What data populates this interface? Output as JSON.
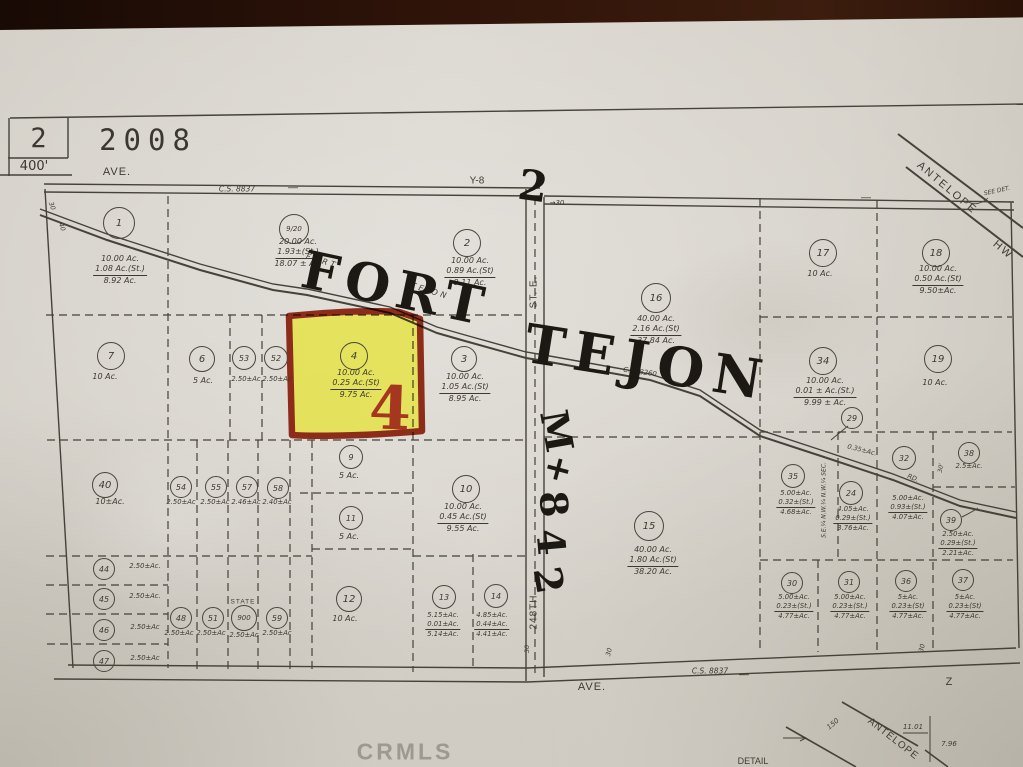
{
  "header": {
    "sheet": "2",
    "year": "2008",
    "scale": "400'"
  },
  "watermark": "CRMLS",
  "colors": {
    "paper": "#d8d4cd",
    "ink": "#45423a",
    "highlight": "#e6e42e",
    "highlight_border": "#8e2c1b",
    "marker": "#1c1914",
    "red_annotation": "#a53620",
    "photo_background": "#2a150d"
  },
  "parcels": [
    {
      "n": "1",
      "cx": 118,
      "cy": 222,
      "r": 15,
      "lx": 120,
      "ly": 254,
      "lines": [
        "10.00 Ac.",
        "1.08 Ac.(St.)",
        "8.92 Ac."
      ]
    },
    {
      "n": "9/20",
      "cx": 293,
      "cy": 228,
      "r": 14,
      "lx": 298,
      "ly": 237,
      "lines": [
        "20.00 Ac.",
        "1.93±(St.)",
        "18.07 ± Ac."
      ]
    },
    {
      "n": "2",
      "cx": 466,
      "cy": 242,
      "r": 13,
      "lx": 470,
      "ly": 256,
      "lines": [
        "10.00 Ac.",
        "0.89 Ac.(St)",
        "9.11 Ac."
      ]
    },
    {
      "n": "7",
      "cx": 110,
      "cy": 355,
      "r": 13,
      "lx": 105,
      "ly": 372,
      "lines": [
        "10 Ac."
      ]
    },
    {
      "n": "6",
      "cx": 201,
      "cy": 358,
      "r": 12,
      "lx": 203,
      "ly": 376,
      "lines": [
        "5 Ac."
      ]
    },
    {
      "n": "53",
      "cx": 243,
      "cy": 357,
      "r": 11,
      "sm": true,
      "lx": 246,
      "ly": 375,
      "lines": [
        "2.50±Ac"
      ]
    },
    {
      "n": "52",
      "cx": 275,
      "cy": 357,
      "r": 11,
      "sm": true,
      "lx": 277,
      "ly": 375,
      "lines": [
        "2.50±Ac"
      ]
    },
    {
      "n": "4",
      "cx": 353,
      "cy": 355,
      "r": 13,
      "lx": 356,
      "ly": 368,
      "lines": [
        "10.00 Ac.",
        "0.25 Ac.(St)",
        "9.75 Ac."
      ]
    },
    {
      "n": "3",
      "cx": 463,
      "cy": 358,
      "r": 12,
      "lx": 465,
      "ly": 372,
      "lines": [
        "10.00 Ac.",
        "1.05 Ac.(St)",
        "8.95 Ac."
      ]
    },
    {
      "n": "16",
      "cx": 655,
      "cy": 297,
      "r": 14,
      "lx": 656,
      "ly": 314,
      "lines": [
        "40.00 Ac.",
        "2.16 Ac.(St)",
        "37.84 Ac."
      ]
    },
    {
      "n": "17",
      "cx": 822,
      "cy": 252,
      "r": 13,
      "lx": 820,
      "ly": 269,
      "lines": [
        "10 Ac."
      ]
    },
    {
      "n": "18",
      "cx": 935,
      "cy": 252,
      "r": 13,
      "lx": 938,
      "ly": 264,
      "lines": [
        "10.00 Ac.",
        "0.50 Ac.(St)",
        "9.50±Ac."
      ]
    },
    {
      "n": "34",
      "cx": 822,
      "cy": 360,
      "r": 13,
      "lx": 825,
      "ly": 376,
      "lines": [
        "10.00 Ac.",
        "0.01 ± Ac.(St.)",
        "9.99 ± Ac."
      ]
    },
    {
      "n": "19",
      "cx": 937,
      "cy": 358,
      "r": 13,
      "lx": 935,
      "ly": 378,
      "lines": [
        "10 Ac."
      ]
    },
    {
      "n": "29",
      "cx": 851,
      "cy": 417,
      "r": 10,
      "lx": 851,
      "ly": 430,
      "lines": []
    },
    {
      "n": "35",
      "cx": 792,
      "cy": 475,
      "r": 11,
      "sm": true,
      "lx": 796,
      "ly": 489,
      "lines": [
        "5.00±Ac.",
        "0.32±(St.)",
        "4.68±Ac."
      ]
    },
    {
      "n": "24",
      "cx": 850,
      "cy": 492,
      "r": 11,
      "sm": true,
      "lx": 853,
      "ly": 505,
      "lines": [
        "4.05±Ac.",
        "0.29±(St.)",
        "3.76±Ac."
      ]
    },
    {
      "n": "32",
      "cx": 903,
      "cy": 457,
      "r": 11,
      "sm": true,
      "lx": 908,
      "ly": 494,
      "lines": [
        "5.00±Ac.",
        "0.93±(St.)",
        "4.07±Ac."
      ]
    },
    {
      "n": "38",
      "cx": 968,
      "cy": 452,
      "r": 10,
      "sm": true,
      "lx": 969,
      "ly": 462,
      "lines": [
        "2.5±Ac."
      ]
    },
    {
      "n": "39",
      "cx": 950,
      "cy": 519,
      "r": 10,
      "sm": true,
      "lx": 958,
      "ly": 530,
      "lines": [
        "2.50±Ac.",
        "0.29±(St.)",
        "2.21±Ac."
      ]
    },
    {
      "n": "15",
      "cx": 648,
      "cy": 525,
      "r": 14,
      "lx": 653,
      "ly": 545,
      "lines": [
        "40.00 Ac.",
        "1.80 Ac.(St)",
        "38.20 Ac."
      ]
    },
    {
      "n": "10",
      "cx": 465,
      "cy": 488,
      "r": 13,
      "lx": 463,
      "ly": 502,
      "lines": [
        "10.00 Ac.",
        "0.45 Ac.(St)",
        "9.55 Ac."
      ]
    },
    {
      "n": "9",
      "cx": 350,
      "cy": 456,
      "r": 11,
      "lx": 349,
      "ly": 471,
      "lines": [
        "5 Ac."
      ]
    },
    {
      "n": "11",
      "cx": 350,
      "cy": 517,
      "r": 11,
      "lx": 349,
      "ly": 532,
      "lines": [
        "5 Ac."
      ]
    },
    {
      "n": "40",
      "cx": 104,
      "cy": 484,
      "r": 12,
      "lx": 110,
      "ly": 497,
      "lines": [
        "10±Ac."
      ]
    },
    {
      "n": "54",
      "cx": 180,
      "cy": 486,
      "r": 10,
      "sm": true,
      "lx": 181,
      "ly": 498,
      "lines": [
        "2.50±Ac"
      ]
    },
    {
      "n": "55",
      "cx": 215,
      "cy": 486,
      "r": 10,
      "sm": true,
      "lx": 215,
      "ly": 498,
      "lines": [
        "2.50±Ac"
      ]
    },
    {
      "n": "57",
      "cx": 246,
      "cy": 486,
      "r": 10,
      "sm": true,
      "lx": 246,
      "ly": 498,
      "lines": [
        "2.46±Ac"
      ]
    },
    {
      "n": "58",
      "cx": 277,
      "cy": 487,
      "r": 10,
      "sm": true,
      "lx": 277,
      "ly": 498,
      "lines": [
        "2.40±Ac"
      ]
    },
    {
      "n": "44",
      "cx": 103,
      "cy": 568,
      "r": 10,
      "sm": true,
      "lx": 145,
      "ly": 562,
      "lines": [
        "2.50±Ac."
      ]
    },
    {
      "n": "45",
      "cx": 103,
      "cy": 598,
      "r": 10,
      "sm": true,
      "lx": 145,
      "ly": 592,
      "lines": [
        "2.50±Ac."
      ]
    },
    {
      "n": "46",
      "cx": 103,
      "cy": 629,
      "r": 10,
      "sm": true,
      "lx": 145,
      "ly": 623,
      "lines": [
        "2.50±Ac"
      ]
    },
    {
      "n": "47",
      "cx": 103,
      "cy": 660,
      "r": 10,
      "sm": true,
      "lx": 145,
      "ly": 654,
      "lines": [
        "2.50±Ac"
      ]
    },
    {
      "n": "48",
      "cx": 180,
      "cy": 617,
      "r": 10,
      "sm": true,
      "lx": 179,
      "ly": 629,
      "lines": [
        "2.50±Ac"
      ]
    },
    {
      "n": "51",
      "cx": 212,
      "cy": 617,
      "r": 10,
      "sm": true,
      "lx": 211,
      "ly": 629,
      "lines": [
        "2.50±Ac"
      ]
    },
    {
      "n": "900",
      "cx": 243,
      "cy": 617,
      "r": 12,
      "sm": true,
      "lx": 244,
      "ly": 631,
      "lines": [
        "2.50±Ac"
      ]
    },
    {
      "n": "59",
      "cx": 276,
      "cy": 617,
      "r": 10,
      "sm": true,
      "lx": 277,
      "ly": 629,
      "lines": [
        "2.50±Ac"
      ]
    },
    {
      "n": "12",
      "cx": 348,
      "cy": 598,
      "r": 12,
      "lx": 345,
      "ly": 614,
      "lines": [
        "10 Ac."
      ]
    },
    {
      "n": "13",
      "cx": 443,
      "cy": 596,
      "r": 11,
      "sm": true,
      "lx": 443,
      "ly": 611,
      "lines": [
        "5.15±Ac.",
        "0.01±Ac.",
        "5.14±Ac."
      ]
    },
    {
      "n": "14",
      "cx": 495,
      "cy": 595,
      "r": 11,
      "sm": true,
      "lx": 492,
      "ly": 611,
      "lines": [
        "4.85±Ac.",
        "0.44±Ac.",
        "4.41±Ac."
      ]
    },
    {
      "n": "30",
      "cx": 791,
      "cy": 582,
      "r": 10,
      "sm": true,
      "lx": 794,
      "ly": 593,
      "lines": [
        "5.00±Ac.",
        "0.23±(St.)",
        "4.77±Ac."
      ]
    },
    {
      "n": "31",
      "cx": 848,
      "cy": 581,
      "r": 10,
      "sm": true,
      "lx": 850,
      "ly": 593,
      "lines": [
        "5.00±Ac.",
        "0.23±(St.)",
        "4.77±Ac."
      ]
    },
    {
      "n": "36",
      "cx": 905,
      "cy": 580,
      "r": 10,
      "sm": true,
      "lx": 908,
      "ly": 593,
      "lines": [
        "5±Ac.",
        "0.23±(St)",
        "4.77±Ac."
      ]
    },
    {
      "n": "37",
      "cx": 962,
      "cy": 579,
      "r": 10,
      "sm": true,
      "lx": 965,
      "ly": 593,
      "lines": [
        "5±Ac.",
        "0.23±(St)",
        "4.77±Ac."
      ]
    }
  ],
  "notes": [
    {
      "t": "AVE.",
      "x": 117,
      "y": 172,
      "s": 11,
      "sp": 1,
      "name": "ave-top-label"
    },
    {
      "t": "C.S. 8837",
      "x": 237,
      "y": 189,
      "s": 7.5,
      "i": true,
      "name": "survey-number-top"
    },
    {
      "t": "Y-8",
      "x": 477,
      "y": 181,
      "s": 10,
      "name": "grid-ref-y8"
    },
    {
      "t": "—",
      "x": 293,
      "y": 188,
      "s": 10
    },
    {
      "t": "—",
      "x": 866,
      "y": 198,
      "s": 10
    },
    {
      "t": "→30",
      "x": 557,
      "y": 203,
      "s": 7,
      "i": true
    },
    {
      "t": "30",
      "x": 52,
      "y": 206,
      "r": 70,
      "s": 6.5,
      "i": true
    },
    {
      "t": "40",
      "x": 62,
      "y": 227,
      "r": 70,
      "s": 6.5,
      "i": true
    },
    {
      "t": "FORT",
      "x": 322,
      "y": 261,
      "r": 17,
      "s": 8,
      "sp": 3,
      "i": true,
      "name": "fort-tejon-road-label-1"
    },
    {
      "t": "TEJON",
      "x": 430,
      "y": 291,
      "r": 17,
      "s": 8,
      "sp": 3,
      "i": true,
      "name": "fort-tejon-road-label-2"
    },
    {
      "t": "ST. E.",
      "x": 534,
      "y": 292,
      "r": -90,
      "s": 10,
      "sp": 1,
      "name": "street-st-e-label"
    },
    {
      "t": "C.S. 8260",
      "x": 640,
      "y": 372,
      "r": 8,
      "s": 7,
      "i": true,
      "name": "survey-number-road"
    },
    {
      "t": "0.35±Ac.",
      "x": 862,
      "y": 450,
      "r": 14,
      "s": 6.5,
      "i": true
    },
    {
      "t": "RD.",
      "x": 913,
      "y": 478,
      "r": 22,
      "s": 6.5,
      "i": true
    },
    {
      "t": "S.E.¼ N.W.¼ N.W.¼ SEC.",
      "x": 824,
      "y": 500,
      "r": -90,
      "s": 6,
      "i": true
    },
    {
      "t": "30'",
      "x": 941,
      "y": 468,
      "r": -80,
      "s": 6,
      "i": true
    },
    {
      "t": "STATE",
      "x": 243,
      "y": 602,
      "s": 6.5,
      "sp": 1,
      "name": "state-label"
    },
    {
      "t": "248TH",
      "x": 534,
      "y": 612,
      "r": -90,
      "s": 10,
      "sp": 1,
      "name": "street-248th-label"
    },
    {
      "t": "30",
      "x": 527,
      "y": 649,
      "r": -90,
      "s": 6.5,
      "i": true
    },
    {
      "t": "30",
      "x": 609,
      "y": 652,
      "r": -75,
      "s": 6.5,
      "i": true
    },
    {
      "t": "30",
      "x": 922,
      "y": 648,
      "r": -75,
      "s": 6.5,
      "i": true
    },
    {
      "t": "—",
      "x": 744,
      "y": 675,
      "s": 10
    },
    {
      "t": "C.S. 8837",
      "x": 710,
      "y": 671,
      "s": 7.5,
      "i": true,
      "name": "survey-number-bottom"
    },
    {
      "t": "AVE.",
      "x": 592,
      "y": 687,
      "s": 11,
      "sp": 1,
      "name": "ave-bottom-label"
    },
    {
      "t": "Z",
      "x": 949,
      "y": 682,
      "s": 11,
      "name": "grid-ref-z"
    },
    {
      "t": "ANTELOPE",
      "x": 947,
      "y": 188,
      "r": 40,
      "s": 11,
      "sp": 2,
      "name": "antelope-hwy-label"
    },
    {
      "t": "HW",
      "x": 1003,
      "y": 250,
      "r": 40,
      "s": 11,
      "sp": 2,
      "name": "antelope-hwy-label-2"
    },
    {
      "t": "SEE DET.",
      "x": 997,
      "y": 191,
      "r": -12,
      "s": 6,
      "i": true,
      "name": "see-detail-note"
    },
    {
      "t": "150",
      "x": 833,
      "y": 724,
      "r": -40,
      "s": 7,
      "i": true
    },
    {
      "t": "ANTELOPE",
      "x": 893,
      "y": 739,
      "r": 38,
      "s": 10,
      "sp": 1,
      "name": "antelope-detail-label"
    },
    {
      "t": "11.01",
      "x": 913,
      "y": 727,
      "s": 7,
      "i": true
    },
    {
      "t": "7.96",
      "x": 949,
      "y": 744,
      "s": 7,
      "i": true
    },
    {
      "t": "DETAIL",
      "x": 753,
      "y": 761,
      "s": 9,
      "name": "detail-caption"
    }
  ],
  "handwriting": [
    {
      "t": "FORT",
      "x": 396,
      "y": 289,
      "r": 12,
      "s": 52,
      "sp": 7,
      "name": "handwritten-fort"
    },
    {
      "t": "TEJON",
      "x": 648,
      "y": 362,
      "r": 9,
      "s": 54,
      "sp": 9,
      "name": "handwritten-tejon"
    },
    {
      "t": "2",
      "x": 533,
      "y": 186,
      "r": 8,
      "s": 42,
      "name": "handwritten-2"
    },
    {
      "t": "M",
      "x": 557,
      "y": 431,
      "r": 80,
      "s": 38,
      "name": "handwritten-vertical-m"
    },
    {
      "t": "+",
      "x": 558,
      "y": 469,
      "r": 15,
      "s": 34,
      "name": "handwritten-vertical-plus"
    },
    {
      "t": "8",
      "x": 554,
      "y": 504,
      "r": 85,
      "s": 38,
      "name": "handwritten-vertical-8"
    },
    {
      "t": "4",
      "x": 551,
      "y": 542,
      "r": 85,
      "s": 38,
      "name": "handwritten-vertical-4"
    },
    {
      "t": "2",
      "x": 549,
      "y": 580,
      "r": 80,
      "s": 38,
      "name": "handwritten-vertical-2"
    },
    {
      "t": "4",
      "x": 390,
      "y": 409,
      "r": 2,
      "s": 60,
      "c": "#a53620",
      "name": "parcel-4-highlight-number"
    }
  ]
}
